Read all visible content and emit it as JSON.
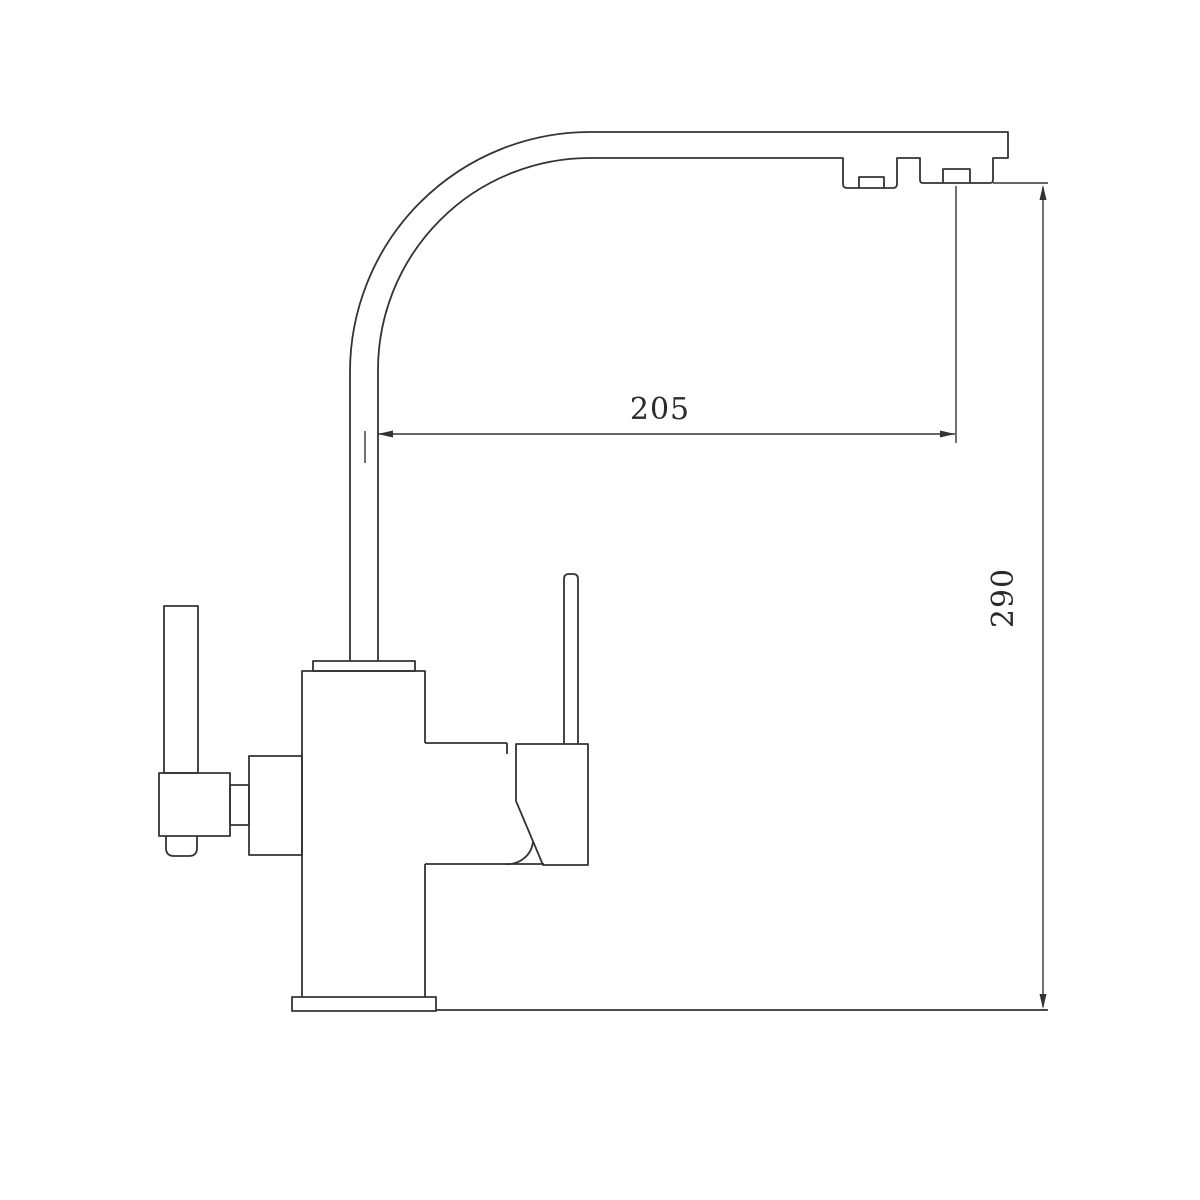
{
  "drawing": {
    "subject": "kitchen-faucet-side-elevation",
    "background_color": "#ffffff",
    "line_color": "#333333",
    "dimensions": {
      "spout_reach": {
        "label": "205"
      },
      "spout_height": {
        "label": "290"
      }
    }
  }
}
